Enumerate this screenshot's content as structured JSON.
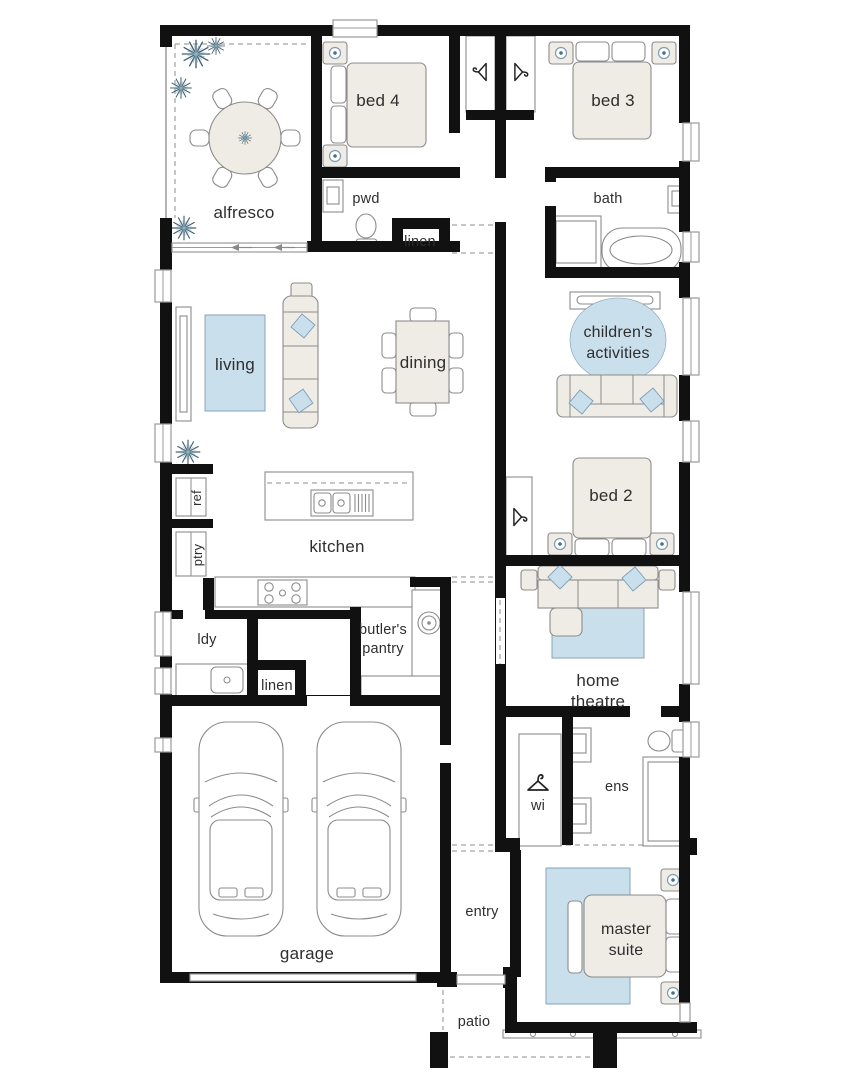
{
  "palette": {
    "wall": "#111111",
    "furniture": "#efece6",
    "furniture_stroke": "#8c8c8c",
    "accent": "#c9dfec",
    "accent_stroke": "#7d9db5",
    "label": "#2e2e2e",
    "line": "#9a9a9a"
  },
  "rooms": {
    "alfresco": {
      "label": "alfresco"
    },
    "bed4": {
      "label": "bed 4"
    },
    "bed3": {
      "label": "bed 3"
    },
    "pwd": {
      "label": "pwd"
    },
    "linen_upper": {
      "label": "linen"
    },
    "bath": {
      "label": "bath"
    },
    "living": {
      "label": "living"
    },
    "dining": {
      "label": "dining"
    },
    "childrens_activities": {
      "line1": "children's",
      "line2": "activities"
    },
    "ref": {
      "label": "ref"
    },
    "ptry": {
      "label": "ptry"
    },
    "kitchen": {
      "label": "kitchen"
    },
    "bed2": {
      "label": "bed 2"
    },
    "ldy": {
      "label": "ldy"
    },
    "butlers_pantry": {
      "line1": "butler's",
      "line2": "pantry"
    },
    "linen_lower": {
      "label": "linen"
    },
    "home_theatre": {
      "line1": "home",
      "line2": "theatre"
    },
    "wi": {
      "label": "wi"
    },
    "ens": {
      "label": "ens"
    },
    "garage": {
      "label": "garage"
    },
    "entry": {
      "label": "entry"
    },
    "master_suite": {
      "line1": "master",
      "line2": "suite"
    },
    "patio": {
      "label": "patio"
    }
  }
}
